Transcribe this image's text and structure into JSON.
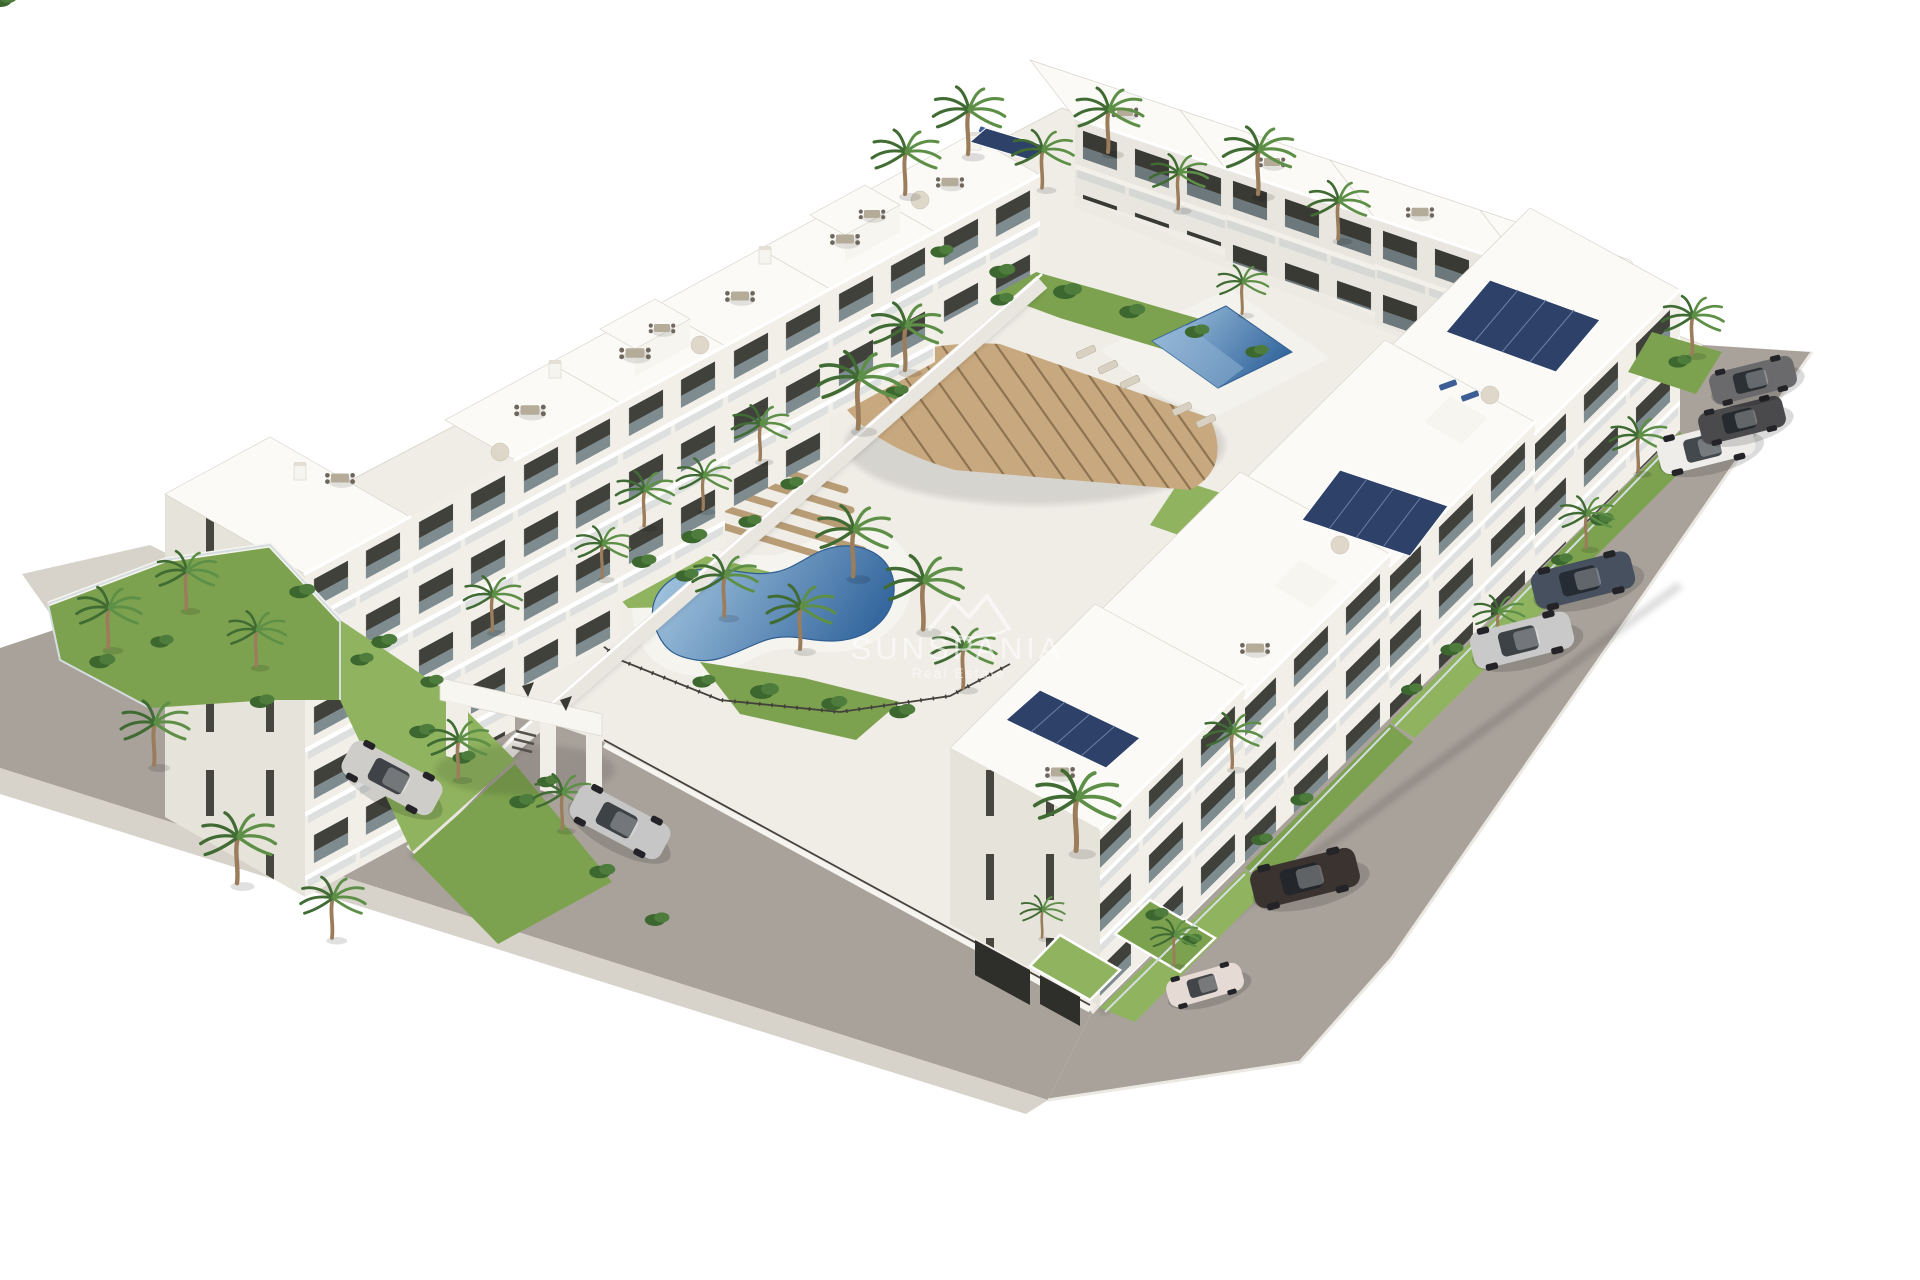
{
  "watermark": {
    "brand": "SUNSPANIA",
    "tagline": "Real Estate",
    "logo": "mountain-peaks-icon"
  },
  "scene": {
    "type": "aerial-3d-architectural-render",
    "subject": "Modern white apartment development with two communal pools, landscaped palm courtyard, curved wooden pergola, entrance gate, perimeter roads and parked cars",
    "background": "#ffffff",
    "colors": {
      "ground": "#f0ede7",
      "road": "#a9a29b",
      "sidewalk": "#d7d3cb",
      "roof": "#fbfaf7",
      "facade_lit": "#f2efe9",
      "facade_shaded": "#e6e3db",
      "window": "#41413c",
      "glass": "#c9d2d6",
      "grass": "#7da24f",
      "shrub": "#3c672f",
      "palm_frond": "#406b33",
      "palm_trunk": "#9b7d5c",
      "pool_deep": "#36689f",
      "pool_shallow": "#aacbe3",
      "pergola_wood": "#c8a87e",
      "solar_panel": "#2e4168",
      "watermark": "#ffffff"
    },
    "pools": [
      {
        "name": "lagoon-pool",
        "shape": "kidney",
        "area": "central courtyard"
      },
      {
        "name": "lap-pool",
        "shape": "rectangular",
        "area": "upper courtyard"
      }
    ],
    "entrance_gate": {
      "style": "white portal over driveway",
      "marks": "two dark A-shaped logo glyphs"
    },
    "cars": [
      {
        "name": "silver-suv",
        "color": "#cfcdc9",
        "road": "southwest",
        "x": 392,
        "y": 778
      },
      {
        "name": "silver-sedan",
        "color": "#c6c6c6",
        "road": "southwest",
        "x": 620,
        "y": 822
      },
      {
        "name": "white-city-car",
        "color": "#e6dad4",
        "road": "south-corner",
        "x": 1205,
        "y": 985
      },
      {
        "name": "dark-suv",
        "color": "#3a332f",
        "road": "southeast",
        "x": 1305,
        "y": 878
      },
      {
        "name": "silver-coupe",
        "color": "#c9c9c9",
        "road": "southeast",
        "x": 1522,
        "y": 640
      },
      {
        "name": "graphite-sedan",
        "color": "#46505e",
        "road": "southeast",
        "x": 1583,
        "y": 580
      },
      {
        "name": "white-suv",
        "color": "#efedea",
        "road": "southeast",
        "x": 1706,
        "y": 447
      },
      {
        "name": "charcoal-sedan",
        "color": "#4a4a4c",
        "road": "southeast",
        "x": 1742,
        "y": 420
      },
      {
        "name": "grey-hatchback",
        "color": "#6a6a6c",
        "road": "northeast-corner",
        "x": 1753,
        "y": 380
      }
    ],
    "counts": {
      "apartment_blocks": 11,
      "palm_trees": 36,
      "parked_cars": 9,
      "pools": 2,
      "solar_arrays": 6
    }
  }
}
